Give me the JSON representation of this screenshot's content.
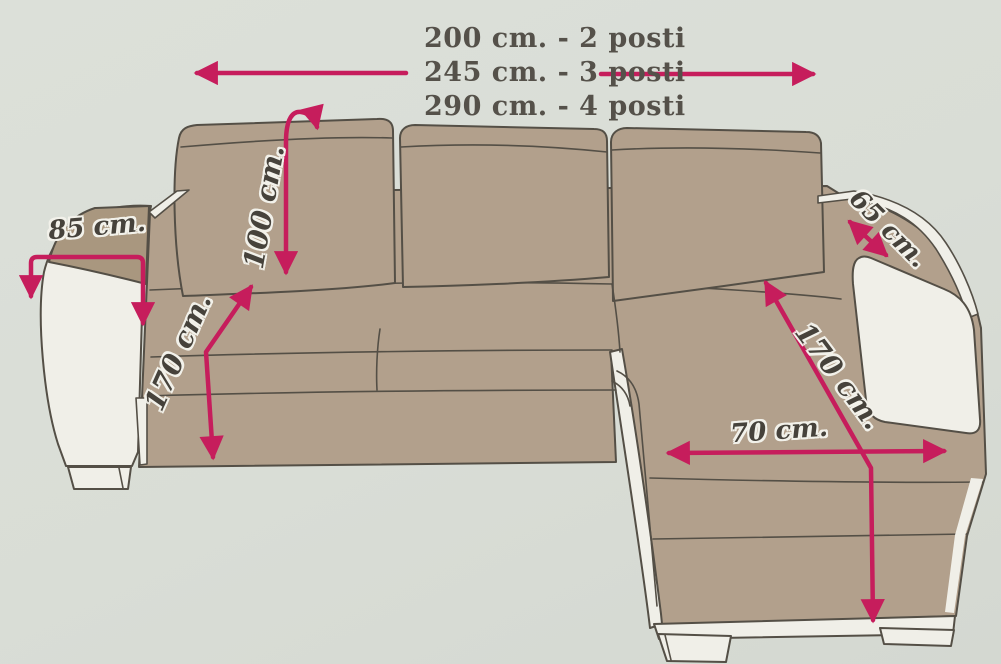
{
  "title": {
    "size_options": [
      "200 cm. - 2 posti",
      "245 cm. - 3 posti",
      "290 cm. - 4 posti"
    ]
  },
  "dimensions": {
    "back_height": "100 cm.",
    "left_armrest_depth": "85 cm.",
    "right_armrest_depth": "65 cm.",
    "sofa_diagonal_left": "170 cm.",
    "chaise_diagonal": "170 cm.",
    "chaise_width": "70 cm."
  },
  "colors": {
    "background": "#d9ddd6",
    "sofa_fill": "#b2a08c",
    "panel_white": "#f0efe8",
    "outline": "#544f46",
    "arrow_pink": "#c61d5c",
    "label_text": "#46423b"
  }
}
